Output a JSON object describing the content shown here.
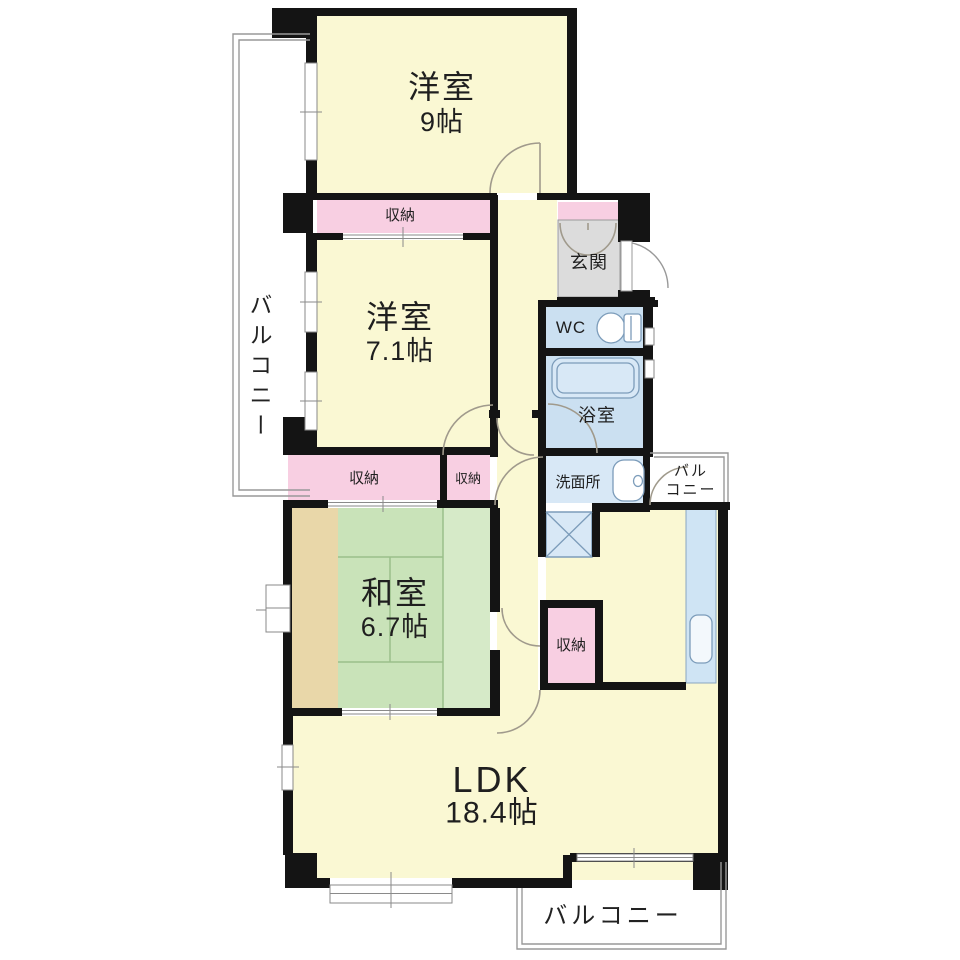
{
  "plan_title": "マンション間取り図",
  "rooms": {
    "western9": {
      "name": "洋室",
      "size": "9帖"
    },
    "western71": {
      "name": "洋室",
      "size": "7.1帖"
    },
    "japanese": {
      "name": "和室",
      "size": "6.7帖"
    },
    "ldk": {
      "name": "LDK",
      "size": "18.4帖"
    }
  },
  "labels": {
    "entrance": "玄関",
    "toilet": "WC",
    "bath": "浴室",
    "washroom": "洗面所",
    "storage": "収納",
    "balcony": "バルコニー",
    "balcony_right_line1": "バル",
    "balcony_right_line2": "コニー"
  },
  "colors": {
    "wall": "#141414",
    "room_yellow": "#FAF8D3",
    "storage_pink": "#F8CFE2",
    "entrance_gray": "#DCDCDC",
    "wet_area_blue": "#CBE0F1",
    "washroom_blue": "#D8E8F6",
    "kitchen_counter_blue": "#CFE4F4",
    "tatami_green": "#C9E3B9",
    "tatami_green_light": "#D6EAC8",
    "wood_tan": "#E9D7A9",
    "balcony_line": "#999999",
    "door_arc": "#A09A8C"
  }
}
